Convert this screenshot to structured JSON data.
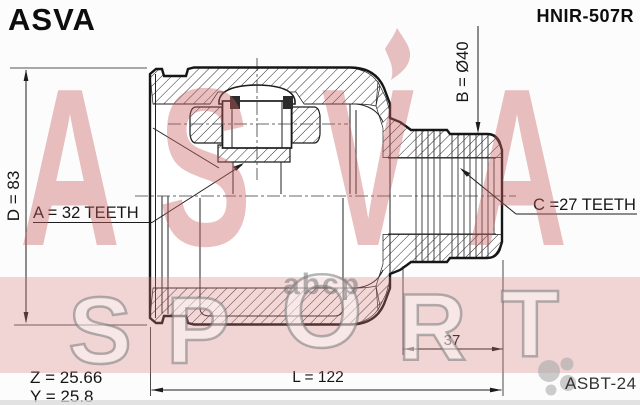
{
  "header": {
    "brand_logo": "ASVA",
    "part_number": "HNIR-507R"
  },
  "labels": {
    "outer_diameter": "D = 83",
    "inner_spline": "A = 32 TEETH",
    "shaft_diameter": "B = Ø40",
    "outer_spline": "C =27 TEETH",
    "dim_z": "Z = 25.66",
    "dim_y": "Y = 25.8",
    "length": "L = 122",
    "stub_length": "37",
    "ref_code": "ASBT-24"
  },
  "watermarks": {
    "brand_letters": [
      "A",
      "S",
      "V",
      "A"
    ],
    "sport_letters": [
      "S",
      "P",
      "O",
      "R",
      "T"
    ],
    "abcp": "abcp"
  },
  "colors": {
    "line": "#1c1c1c",
    "pink_letter": "rgba(199,94,94,0.40)",
    "pink_band": "rgba(214,120,120,0.30)",
    "gray_watermark": "rgba(120,120,120,0.55)"
  }
}
